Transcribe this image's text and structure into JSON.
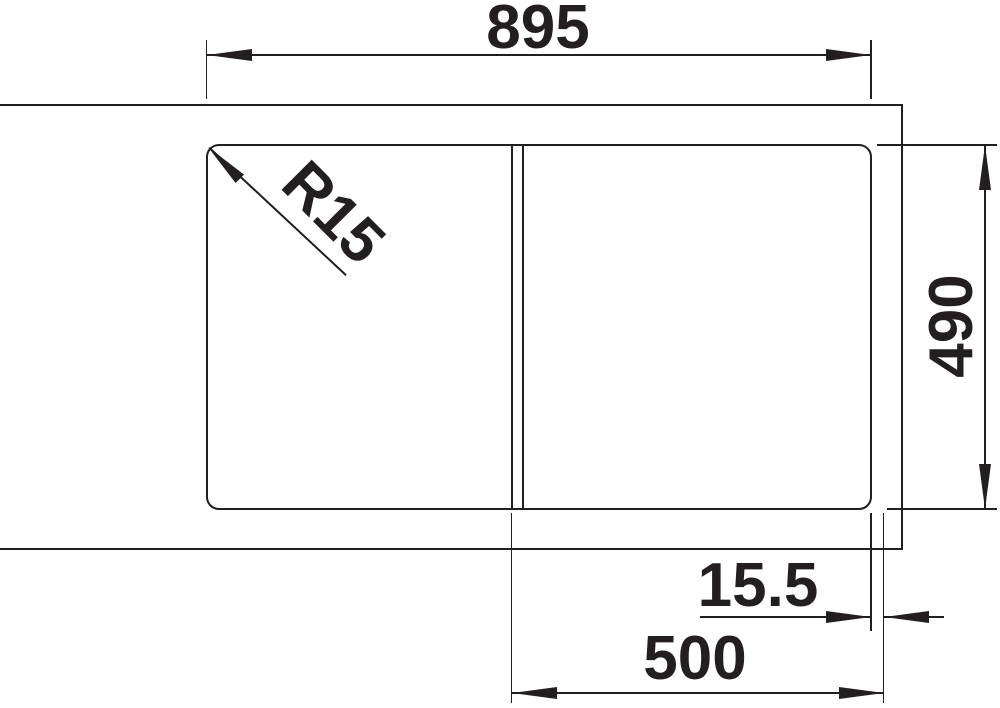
{
  "drawing": {
    "type": "technical-dimension-drawing",
    "subject": "kitchen sink top view with bowl and divider",
    "background_color": "#ffffff",
    "line_color": "#231f20",
    "labels": {
      "overall_width": "895",
      "depth": "490",
      "web_offset": "15.5",
      "bowl_width": "500",
      "corner_radius": "R15"
    }
  }
}
